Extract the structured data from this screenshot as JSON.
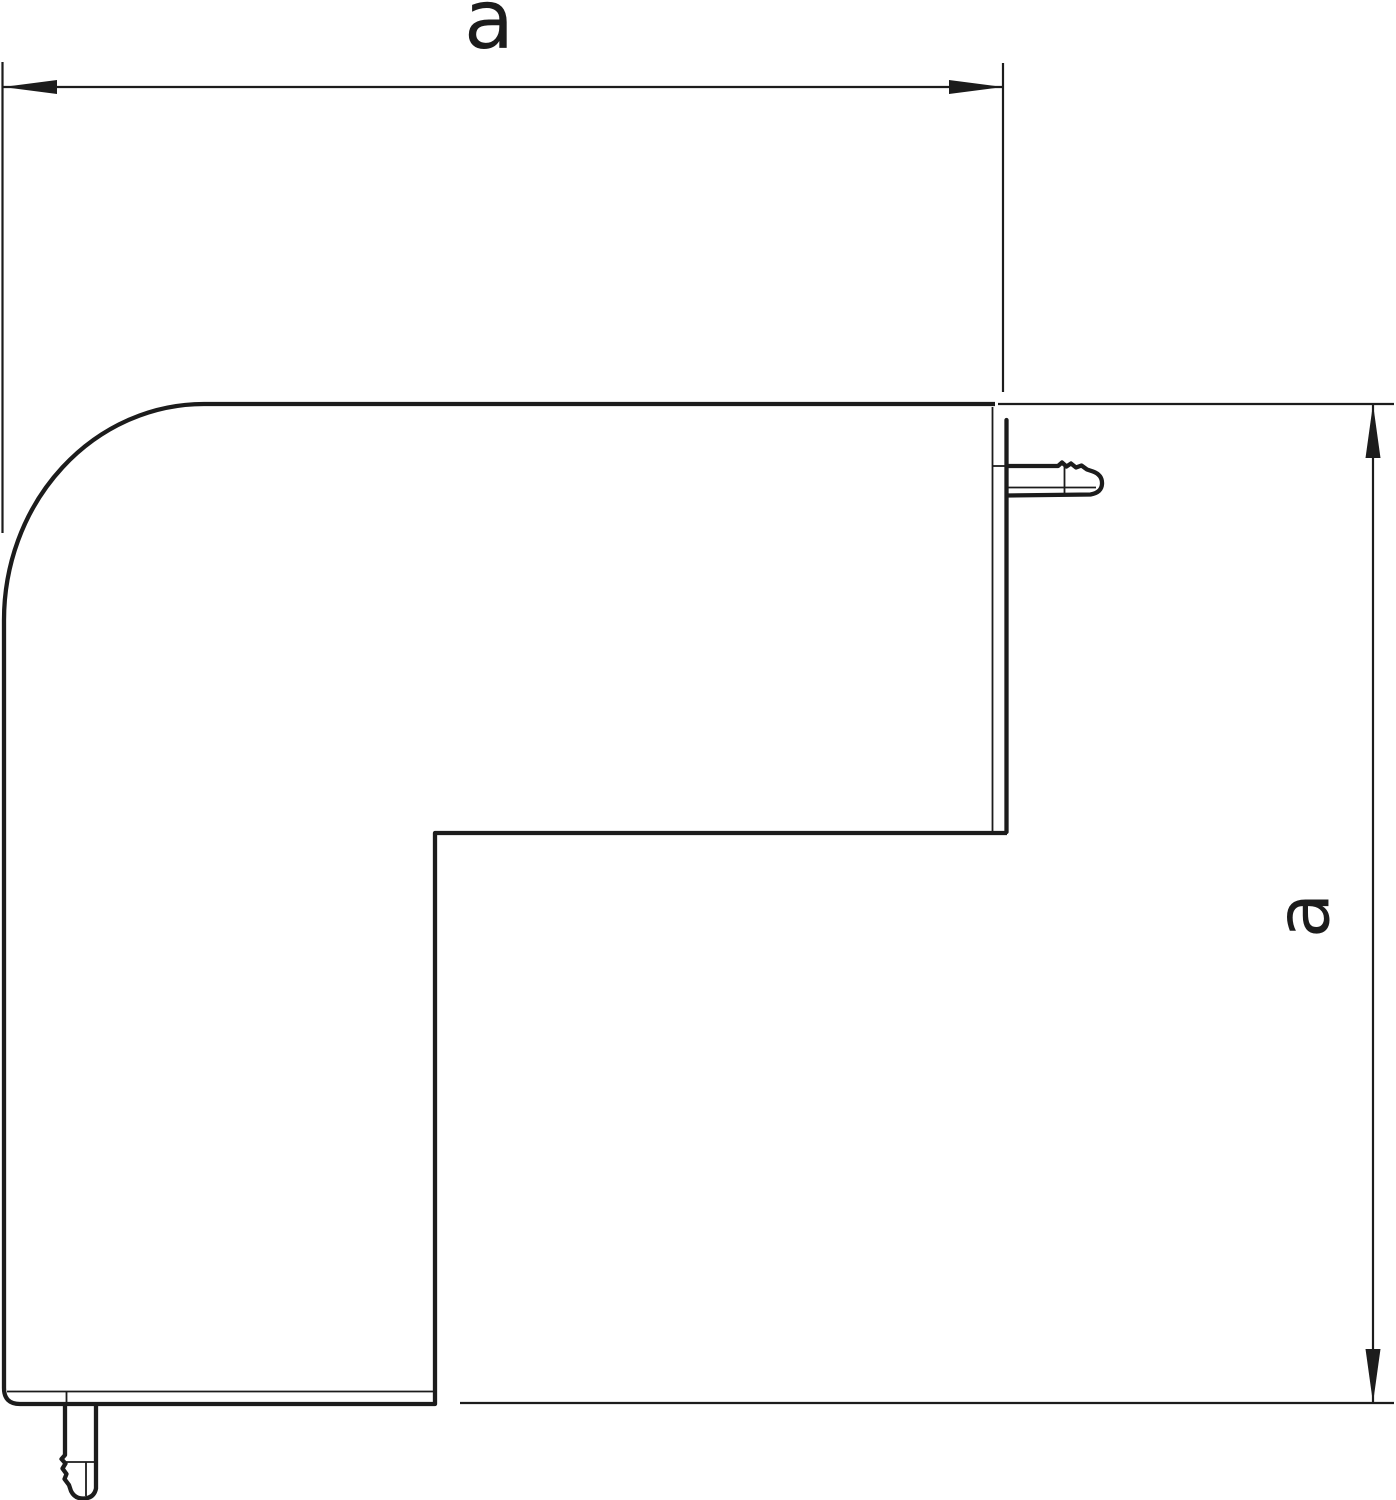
{
  "figure": {
    "background_color": "#ffffff",
    "line_color": "#1c1c1c",
    "dimensions": {
      "horizontal": {
        "label": "a"
      },
      "vertical": {
        "label": "a"
      }
    }
  }
}
